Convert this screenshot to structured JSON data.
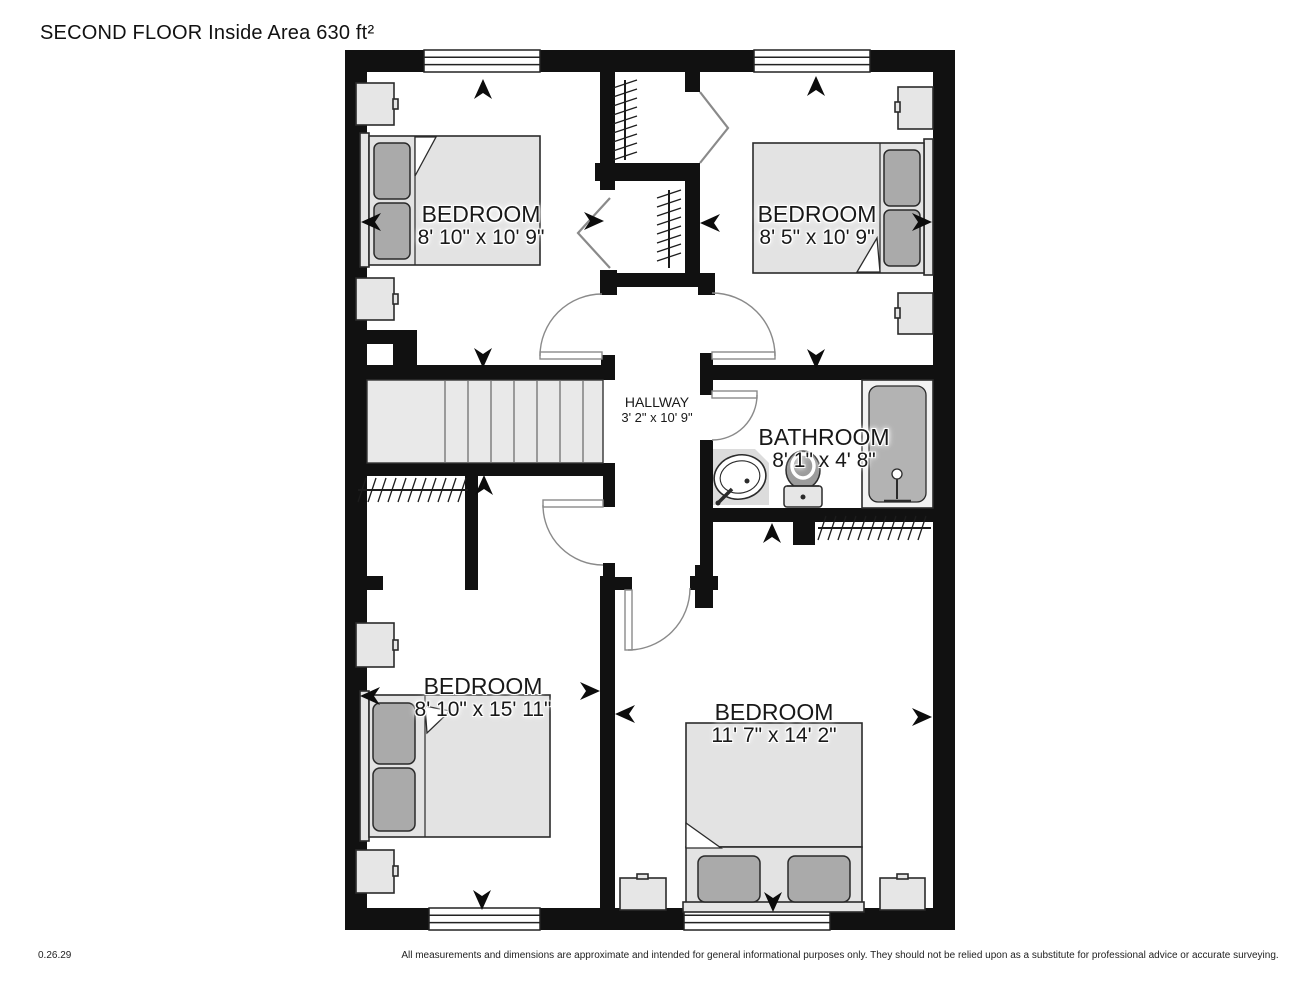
{
  "title": "SECOND FLOOR Inside Area 630 ft²",
  "rooms": {
    "bedroom_top_left": {
      "name": "BEDROOM",
      "dimensions": "8' 10\" x 10' 9\""
    },
    "bedroom_top_right": {
      "name": "BEDROOM",
      "dimensions": "8' 5\" x 10' 9\""
    },
    "hallway": {
      "name": "HALLWAY",
      "dimensions": "3' 2\" x 10' 9\""
    },
    "bathroom": {
      "name": "BATHROOM",
      "dimensions": "8' 1\" x 4' 8\""
    },
    "bedroom_bottom_left": {
      "name": "BEDROOM",
      "dimensions": "8' 10\" x 15' 11\""
    },
    "bedroom_bottom_right": {
      "name": "BEDROOM",
      "dimensions": "11' 7\" x 14' 2\""
    }
  },
  "footer": {
    "version": "0.26.29",
    "disclaimer": "All measurements and dimensions are approximate and intended for general informational purposes only. They should not be relied upon as a substitute for professional advice or accurate surveying."
  },
  "colors": {
    "wall": "#111111",
    "fixture_gray": "#b3b3b3"
  }
}
